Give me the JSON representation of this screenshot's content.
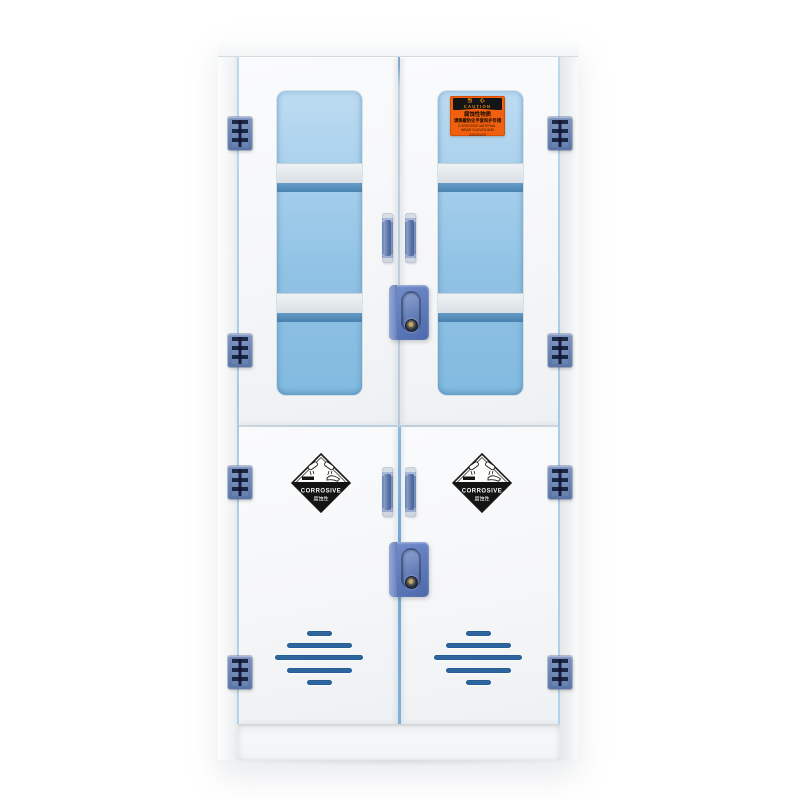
{
  "caution_label": {
    "title_cn": "当 心",
    "title_en": "CAUTION",
    "line1_cn": "腐蚀性物质",
    "line2_cn": "请佩戴防化手套和护目镜",
    "line3_en": "CORROSIVE MATERIAL,",
    "line4_en": "WEAR GLOVES AND GOGGLES"
  },
  "corrosive_label": {
    "en": "CORROSIVE",
    "cn": "腐蚀性"
  },
  "colors": {
    "cabinet_white": "#f6f7f8",
    "glass_blue_top": "#bddcf2",
    "glass_blue_bottom": "#82badf",
    "hinge_blue": "#5e79ab",
    "handle_blue": "#7690c0",
    "lock_blue": "#5d7fc2",
    "vent_slot_blue": "#2f6fae",
    "caution_orange": "#f1600f",
    "diamond_black": "#141414"
  }
}
